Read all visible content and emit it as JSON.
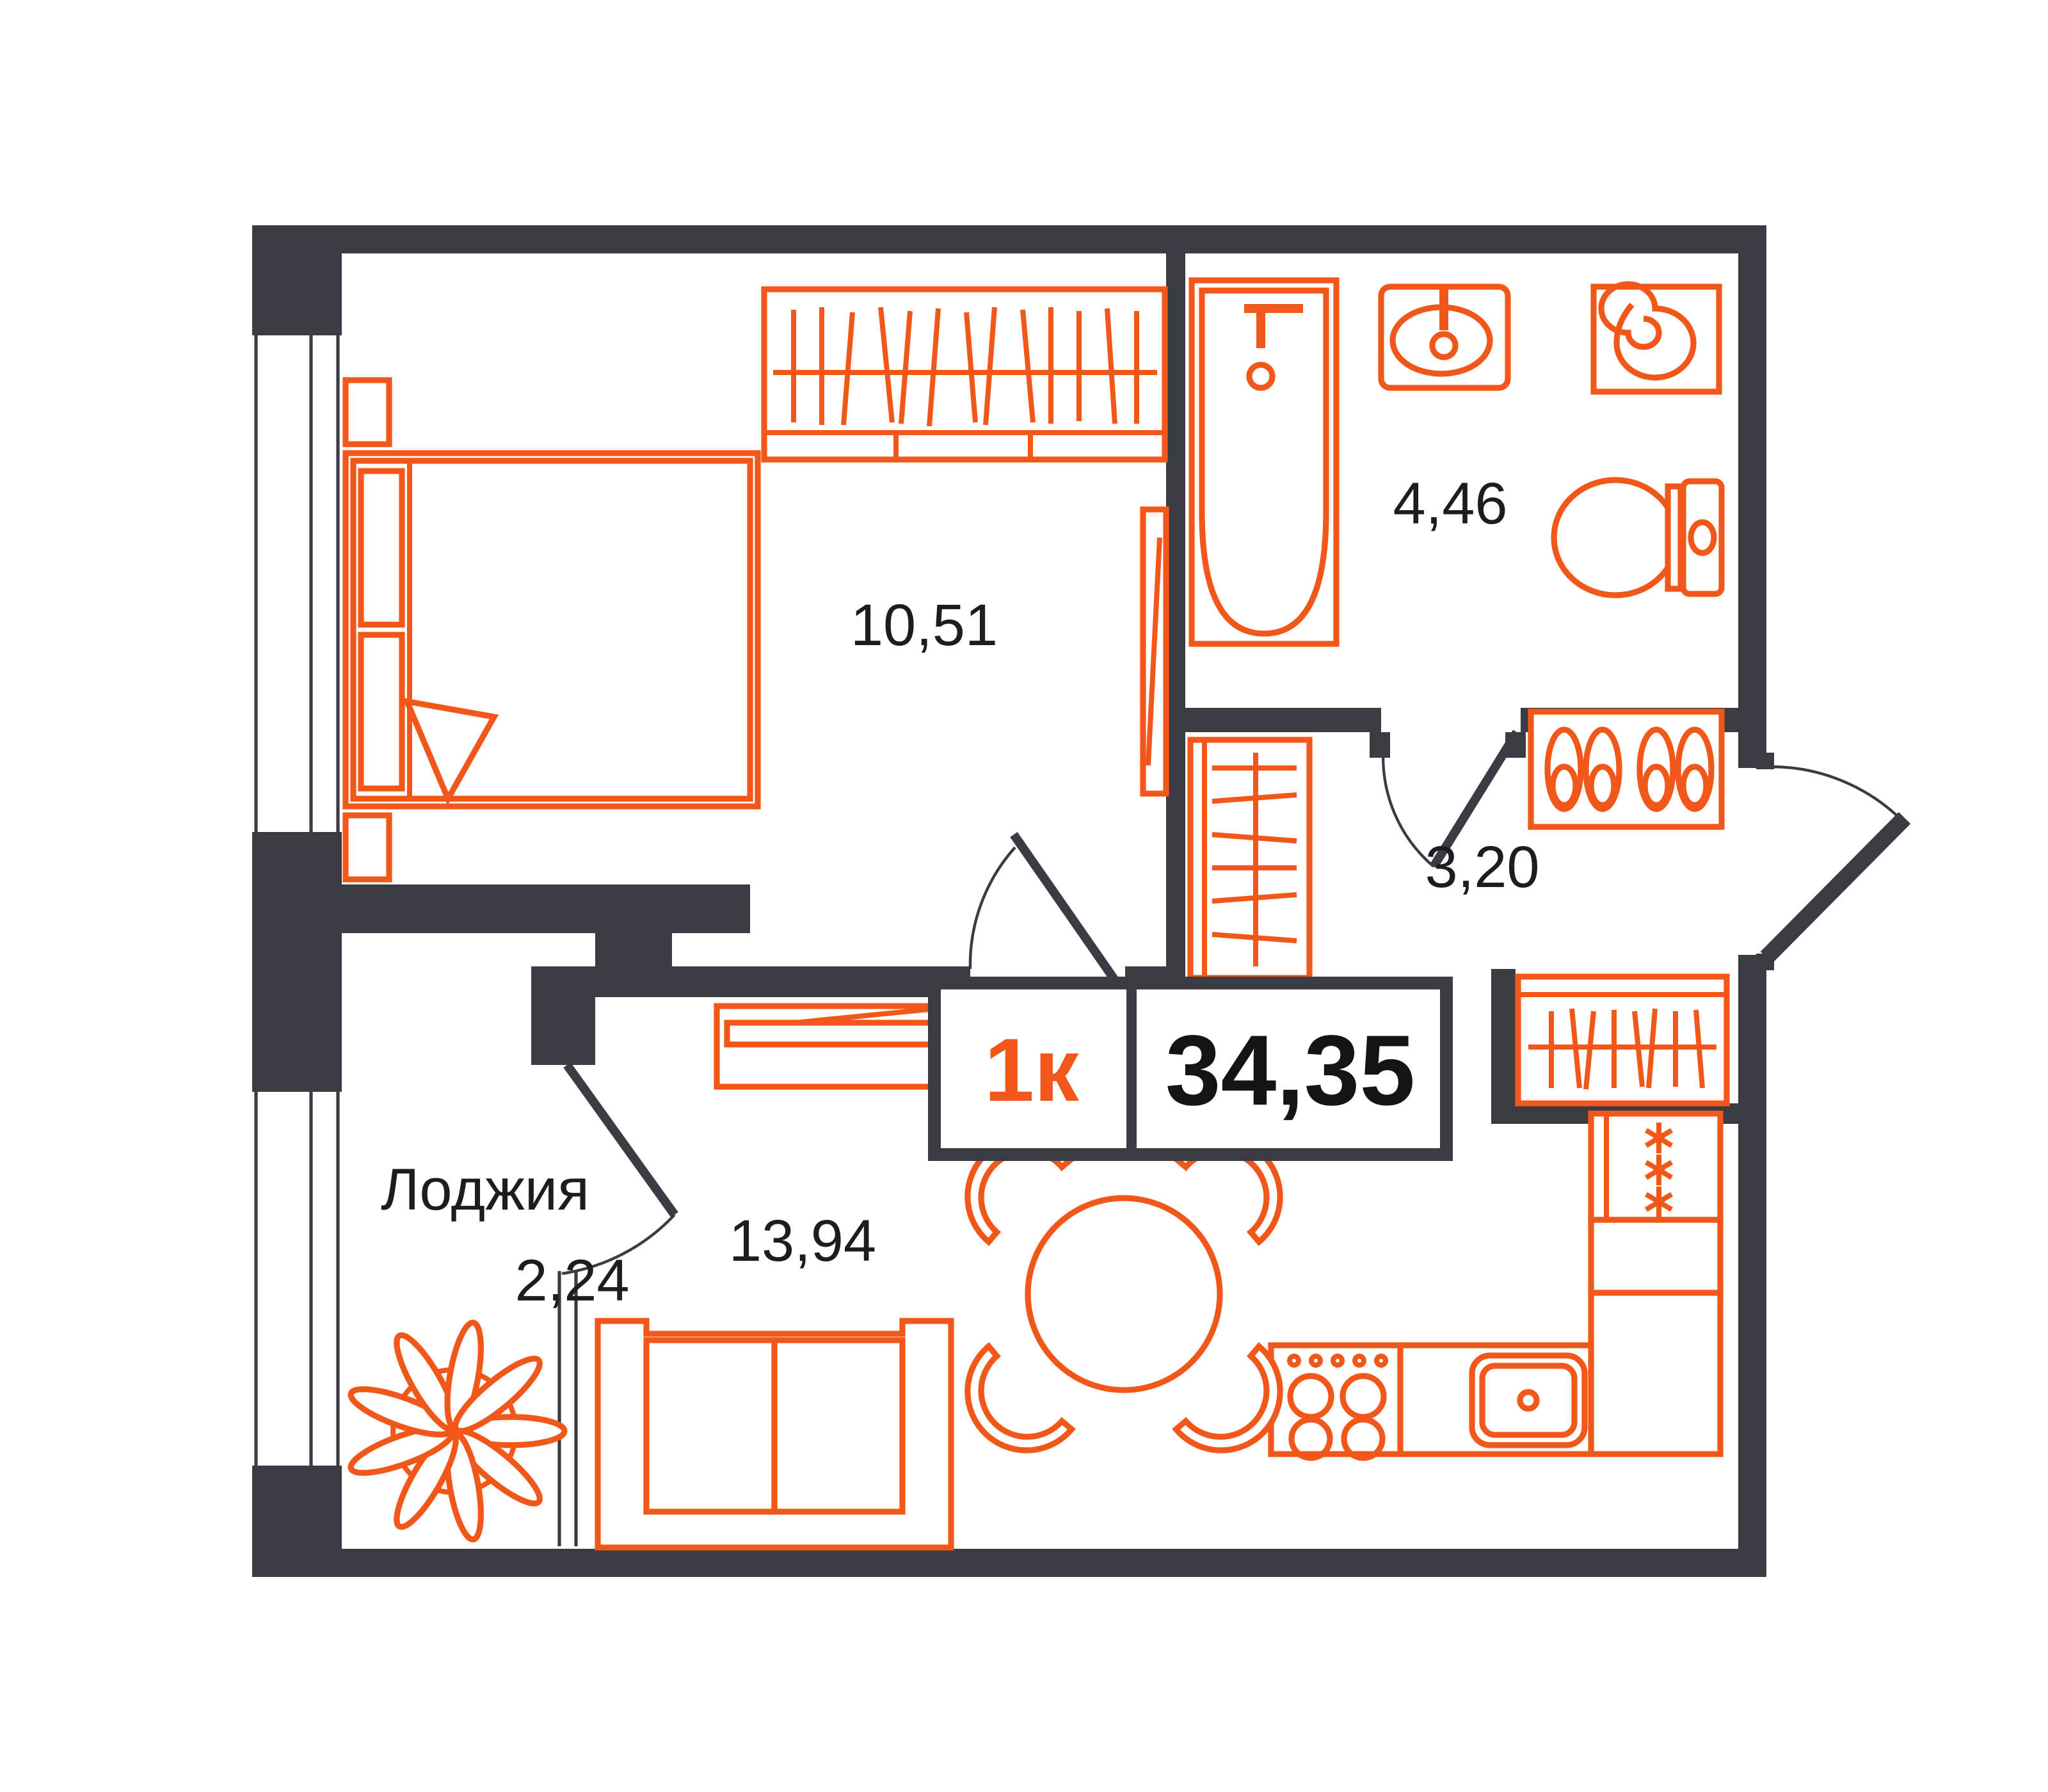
{
  "badge": {
    "rooms": "1к",
    "area": "34,35"
  },
  "rooms": {
    "bedroom": {
      "area": "10,51"
    },
    "bathroom": {
      "area": "4,46"
    },
    "hallway": {
      "area": "3,20"
    },
    "living_kitchen": {
      "area": "13,94"
    },
    "loggia": {
      "name": "Лоджия",
      "area": "2,24"
    }
  },
  "colors": {
    "furniture_accent": "#f2571a",
    "walls": "#3a3b43",
    "background": "#ffffff",
    "label_text": "#1d1d1f"
  }
}
